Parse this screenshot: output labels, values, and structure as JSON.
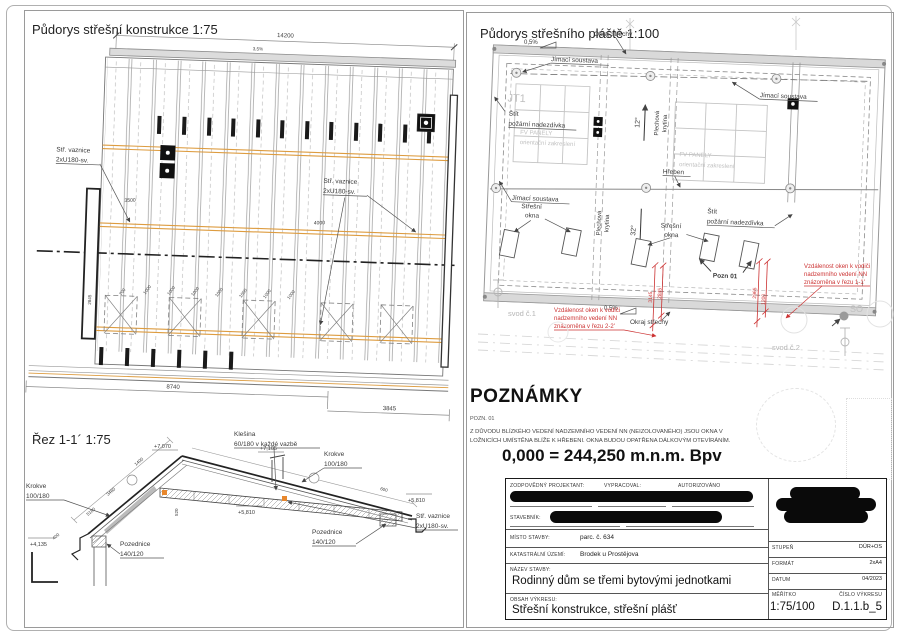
{
  "plan1": {
    "title": "Půdorys střešní konstrukce 1:75",
    "labels": {
      "vaznice1": "Stř. vaznice",
      "vaznice2": "2xU180-sv."
    },
    "dims": {
      "top": "14200",
      "slope": "3,5%",
      "bottom1": "8740",
      "bottom2": "3845",
      "v1": "2845",
      "d4000": "4000",
      "d3500": "3500",
      "d700": "700",
      "d1000": "1000"
    }
  },
  "plan2": {
    "title": "Půdorys střešního pláště 1:100",
    "labels": {
      "okraj": "Okraj střechy",
      "slope": "0,5%",
      "jimaci": "Jímací soustava",
      "jt1": "JT1",
      "stit1": "Štít",
      "stit2": "požární nadezdívka",
      "fv1": "FV PANELY",
      "fv2": "orientační zakreslení",
      "plech1": "Plechová",
      "plech2": "krytina",
      "hreben": "Hřeben",
      "deg12": "12°",
      "deg32": "32°",
      "okna1": "Střešní",
      "okna2": "okna",
      "pozn": "Pozn 01",
      "svod1": "svod č.1",
      "svod2": "svod č.2",
      "so": "SO"
    },
    "red": {
      "l1": "Vzdálenost oken k vodiči",
      "l2": "nadzemního vedení NN",
      "l3a": "znázorněna v řezu 1-1'",
      "l3b": "znázorněna v řezu 2-2'",
      "d1": "3145",
      "d2": "2845",
      "d3": "2965",
      "d4": "1200"
    }
  },
  "section": {
    "title": "Řez 1-1´ 1:75",
    "labels": {
      "klesina1": "Klešina",
      "klesina2": "60/180 v každé vazbě",
      "krokve1": "Krokve",
      "krokve2": "100/180",
      "vaznice1": "Stř. vaznice",
      "vaznice2": "2xU180-sv.",
      "pozednice1": "Pozednice",
      "pozednice2": "140/120"
    },
    "elev": {
      "e1": "+7,070",
      "e2": "+7,105",
      "e3": "+5,810",
      "e4": "+4,135"
    },
    "dims": {
      "d1": "3460",
      "d2": "1400",
      "d3": "5180",
      "d4": "600",
      "d5": "520",
      "d6": "400"
    }
  },
  "notes": {
    "heading": "POZNÁMKY",
    "pozn": "POZN. 01",
    "body1": "Z DŮVODU BLÍZKÉHO VEDENÍ NADZEMNÍHO VEDENÍ NN (NEIZOLOVANÉHO) JSOU OKNA V",
    "body2": "LOŽNICÍCH UMÍSTĚNA BLÍŽE K HŘEBENI. OKNA BUDOU OPATŘENA DÁLKOVÝM OTEVÍRÁNÍM.",
    "datum": "0,000 = 244,250 m.n.m. Bpv"
  },
  "titleblock": {
    "resp": "ZODPOVĚDNÝ PROJEKTANT:",
    "made": "VYPRACOVAL:",
    "auth": "AUTORIZOVÁNO",
    "stavebnik": "STAVEBNÍK:",
    "misto": "MÍSTO STAVBY:",
    "misto_v": "parc. č. 634",
    "katastr": "KATASTRÁLNÍ ÚZEMÍ:",
    "katastr_v": "Brodek u Prostějova",
    "nazev": "NÁZEV STAVBY:",
    "nazev_v": "Rodinný dům se třemi bytovými jednotkami",
    "obsah": "OBSAH VÝKRESU:",
    "obsah_v": "Střešní konstrukce, střešní plášť",
    "stupen": "STUPEŇ",
    "stupen_v": "DÚR+OS",
    "format": "FORMÁT",
    "format_v": "2xA4",
    "datum": "DATUM",
    "datum_v": "04/2023",
    "meritko": "MĚŘÍTKO",
    "meritko_v": "1:75/100",
    "cislo": "ČÍSLO VÝKRESU",
    "cislo_v": "D.1.1.b_5"
  }
}
